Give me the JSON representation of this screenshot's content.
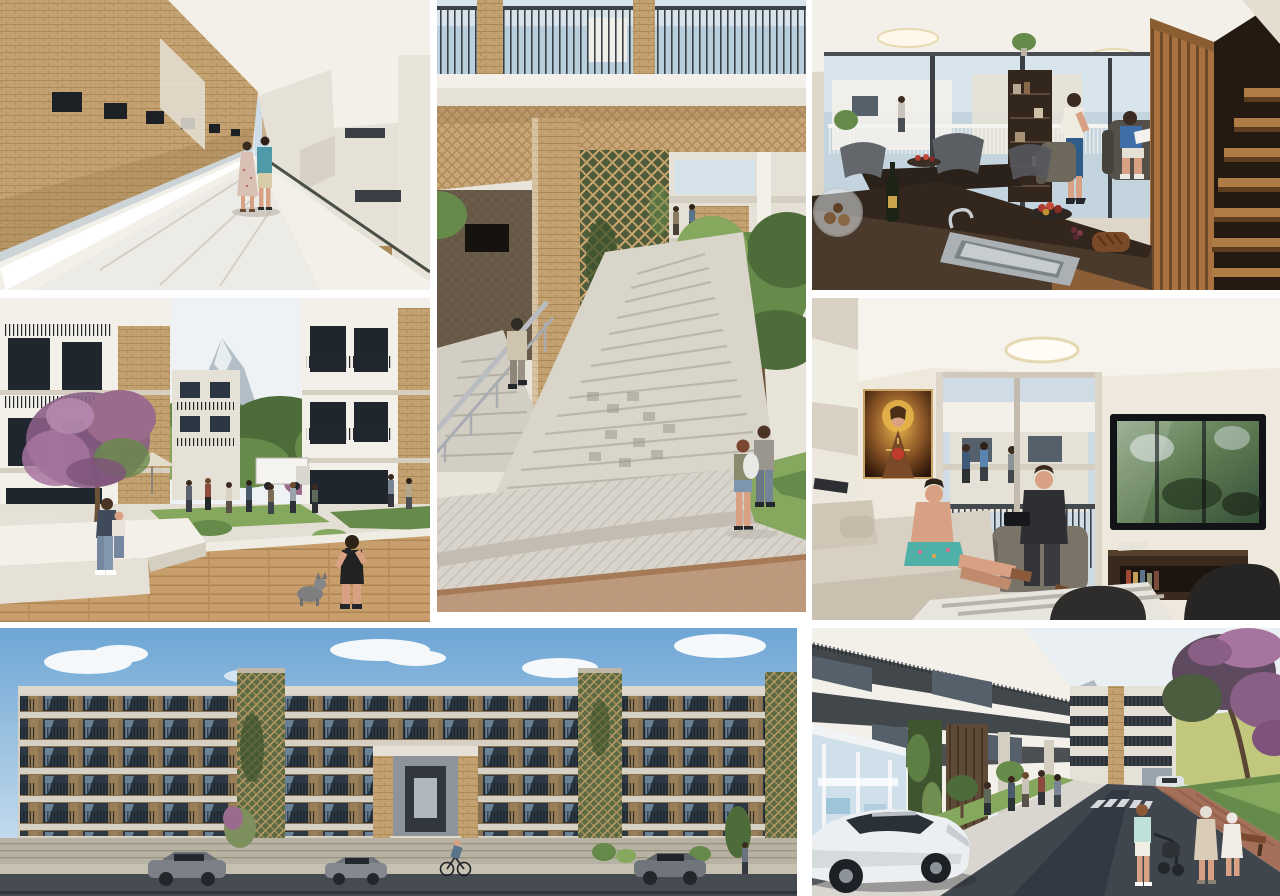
{
  "page": {
    "kind": "architectural-render-collage",
    "description": "Collage of seven photorealistic renderings of a residential apartment complex: exterior walkway, landscaped courtyard, street facade elevation, outdoor stair plaza, duplex kitchen-living interior, living room interior, and street-level view.",
    "background_color": "#ffffff",
    "gutter_px": 8,
    "canvas": {
      "width": 1280,
      "height": 896
    }
  },
  "palette": {
    "brick_tan": "#c6a474",
    "brick_dark": "#8f7044",
    "concrete_white": "#f3f0ea",
    "concrete_gray": "#d5cfc2",
    "window_glass_dark": "#2c3642",
    "glass_reflection_blue": "#8aa4b8",
    "sky_blue": "#79aad4",
    "sky_pale": "#dfe9f1",
    "foliage_green": "#668a49",
    "vine_green": "#5d6b44",
    "deck_wood": "#c89f6c",
    "interior_wood": "#a8713f",
    "road_asphalt": "#454b52",
    "blossom_purple": "#9a6b8a",
    "accent_teal_shirt": "#4f9aa8",
    "accent_blue_skirt": "#2f5d8a"
  },
  "panels": [
    {
      "id": "walkway",
      "name": "panel-access-walkway",
      "description": "Open-air access walkway between brick wall and white balconies; couple walking away (woman in floral dress, man in teal shirt and beige shorts).",
      "position": {
        "x": 0,
        "y": 0,
        "w": 430,
        "h": 290
      },
      "objects": [
        "brick-wall",
        "walkway-floor",
        "parapet-railing",
        "balcony-volumes",
        "couple-walking"
      ]
    },
    {
      "id": "courtyard",
      "name": "panel-courtyard",
      "description": "Landscaped courtyard between apartment blocks with flowering purple tree, mountain peak, residents gathered, woman with child on white bench, boy photographing a dog on wood deck.",
      "position": {
        "x": 0,
        "y": 298,
        "w": 430,
        "h": 324
      },
      "objects": [
        "left-building",
        "right-building",
        "flowering-tree",
        "mountain",
        "trees",
        "white-truck",
        "people-cluster",
        "white-bench",
        "mother-and-child",
        "wood-deck",
        "dog",
        "boy-with-phone"
      ]
    },
    {
      "id": "facade",
      "name": "panel-street-facade",
      "description": "Street elevation of five-storey apartment blocks under blue sky with clouds; green trellis towers, glazed balconies, double-height entrance, parked cars and cyclist.",
      "position": {
        "x": 0,
        "y": 628,
        "w": 797,
        "h": 268
      },
      "objects": [
        "sky-clouds",
        "block-a",
        "trellis-towers",
        "block-b",
        "block-c",
        "entrance-portal",
        "ground-wall",
        "cars",
        "cyclist",
        "street-trees"
      ]
    },
    {
      "id": "stairs",
      "name": "panel-stair-plaza",
      "description": "Wide concrete exterior stairs beneath building with brick soffit and planted brick lattice screen; man ascending left flight, couple standing by tree on herringbone-paved plaza.",
      "position": {
        "x": 437,
        "y": 0,
        "w": 369,
        "h": 612
      },
      "objects": [
        "balcony-railing-top",
        "brick-soffit",
        "brick-pier",
        "lattice-screen",
        "stair-flights",
        "steel-railing",
        "man-ascending",
        "tree",
        "grass",
        "paved-plaza",
        "standing-couple"
      ]
    },
    {
      "id": "kitchen",
      "name": "panel-kitchen-interior",
      "description": "Duplex interior: dark kitchen island with steel sink, wine bottle and fruit, dining chairs, glazed wall to balcony, bookshelf, woman in blue skirt, boy reading in armchair, timber slat screen and stair.",
      "position": {
        "x": 812,
        "y": 0,
        "w": 468,
        "h": 290
      },
      "objects": [
        "ceiling-lights",
        "glazed-wall",
        "balcony-view",
        "bookshelf",
        "dining-set",
        "woman-standing",
        "boy-reading",
        "slat-screen",
        "timber-stair",
        "kitchen-counter",
        "sink",
        "wine-bottle",
        "fruit-bowl",
        "bread"
      ]
    },
    {
      "id": "living",
      "name": "panel-living-interior",
      "description": "Living room: Sacred-Heart painting on wall, glazed balcony door with neighbours beyond, round ceiling light, wall TV showing greenery, man in dark suit with tablet, boy on beige sofa, media console and dark chairs.",
      "position": {
        "x": 812,
        "y": 298,
        "w": 468,
        "h": 322
      },
      "objects": [
        "ceiling-light",
        "religious-painting",
        "balcony-door",
        "neighbour-figures",
        "wall-tv",
        "media-console",
        "seated-man",
        "boy-on-sofa",
        "sofa",
        "rug",
        "foreground-chairs"
      ]
    },
    {
      "id": "street",
      "name": "panel-street-view",
      "description": "Street-level view: apartment blocks with dark balcony bands, glazed corner shop, green wall column, white sedan in foreground, crosswalk, woman with stroller, elderly women, bench, purple blossom tree and rocky mountain.",
      "position": {
        "x": 812,
        "y": 628,
        "w": 468,
        "h": 268
      },
      "objects": [
        "mountain",
        "apartment-blocks",
        "green-wall",
        "shopfront",
        "lawn",
        "road",
        "crosswalk",
        "white-sedan",
        "pedestrians",
        "stroller",
        "bench",
        "blossom-tree"
      ]
    }
  ]
}
